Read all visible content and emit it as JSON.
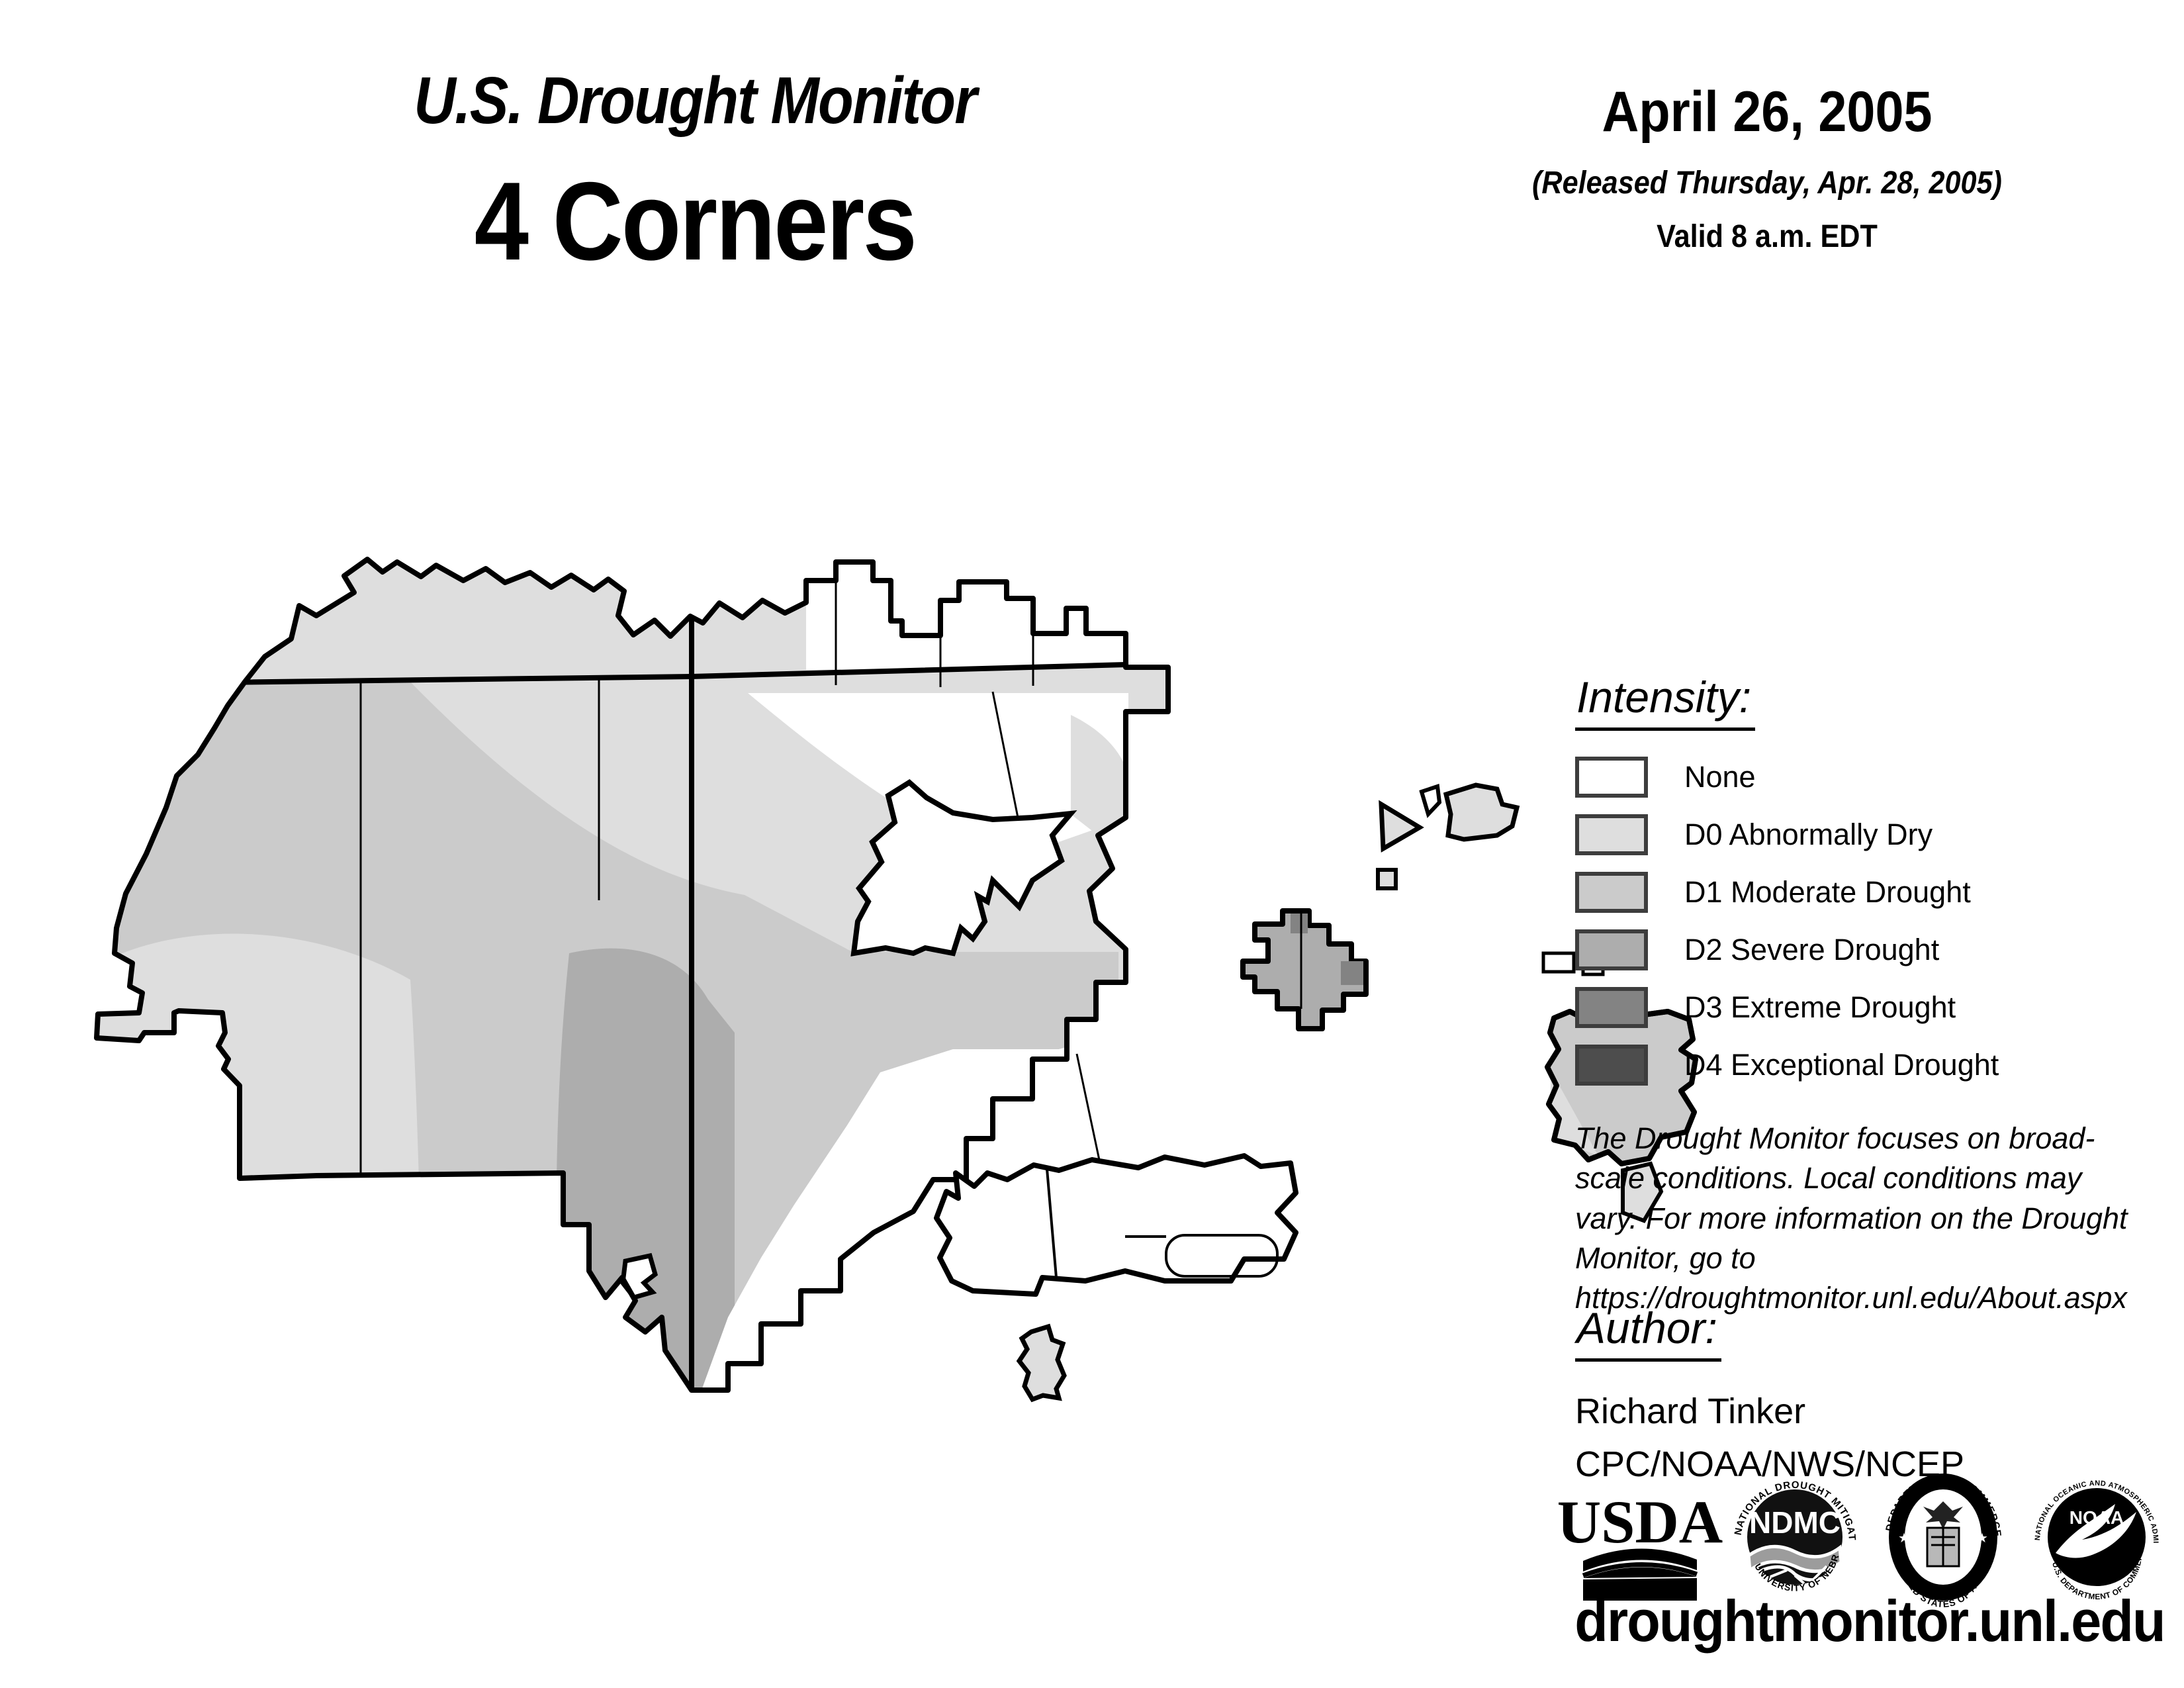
{
  "title": {
    "line1": "U.S. Drought Monitor",
    "line2": "4 Corners"
  },
  "date_block": {
    "date": "April 26, 2005",
    "released": "(Released Thursday, Apr. 28, 2005)",
    "valid": "Valid 8 a.m. EDT"
  },
  "legend": {
    "heading": "Intensity:",
    "items": [
      {
        "key": "none",
        "label": "None"
      },
      {
        "key": "d0",
        "label": "D0 Abnormally Dry"
      },
      {
        "key": "d1",
        "label": "D1 Moderate Drought"
      },
      {
        "key": "d2",
        "label": "D2 Severe Drought"
      },
      {
        "key": "d3",
        "label": "D3 Extreme Drought"
      },
      {
        "key": "d4",
        "label": "D4 Exceptional Drought"
      }
    ],
    "colors": {
      "none": "#ffffff",
      "d0": "#dedede",
      "d1": "#cbcbcb",
      "d2": "#adadad",
      "d3": "#838383",
      "d4": "#4d4d4d"
    },
    "swatch_border": "#3d3d3d"
  },
  "disclaimer": "The Drought Monitor focuses on broad-scale conditions. Local conditions may vary. For more information on the Drought Monitor, go to https://droughtmonitor.unl.edu/About.aspx",
  "author_block": {
    "heading": "Author:",
    "name": "Richard Tinker",
    "org": "CPC/NOAA/NWS/NCEP"
  },
  "logos": {
    "usda": {
      "wordmark": "USDA"
    },
    "ndmc": {
      "acronym": "NDMC",
      "ring_top": "NATIONAL DROUGHT MITIGATION CENTER",
      "ring_bottom": "UNIVERSITY OF NEBRASKA"
    },
    "doc": {
      "ring_top": "DEPARTMENT OF COMMERCE",
      "ring_bottom": "UNITED STATES OF AMERICA"
    },
    "noaa": {
      "acronym": "NOAA",
      "ring_top": "NATIONAL OCEANIC AND ATMOSPHERIC ADMINISTRATION",
      "ring_bottom": "U.S. DEPARTMENT OF COMMERCE"
    }
  },
  "footer": {
    "url": "droughtmonitor.unl.edu"
  }
}
